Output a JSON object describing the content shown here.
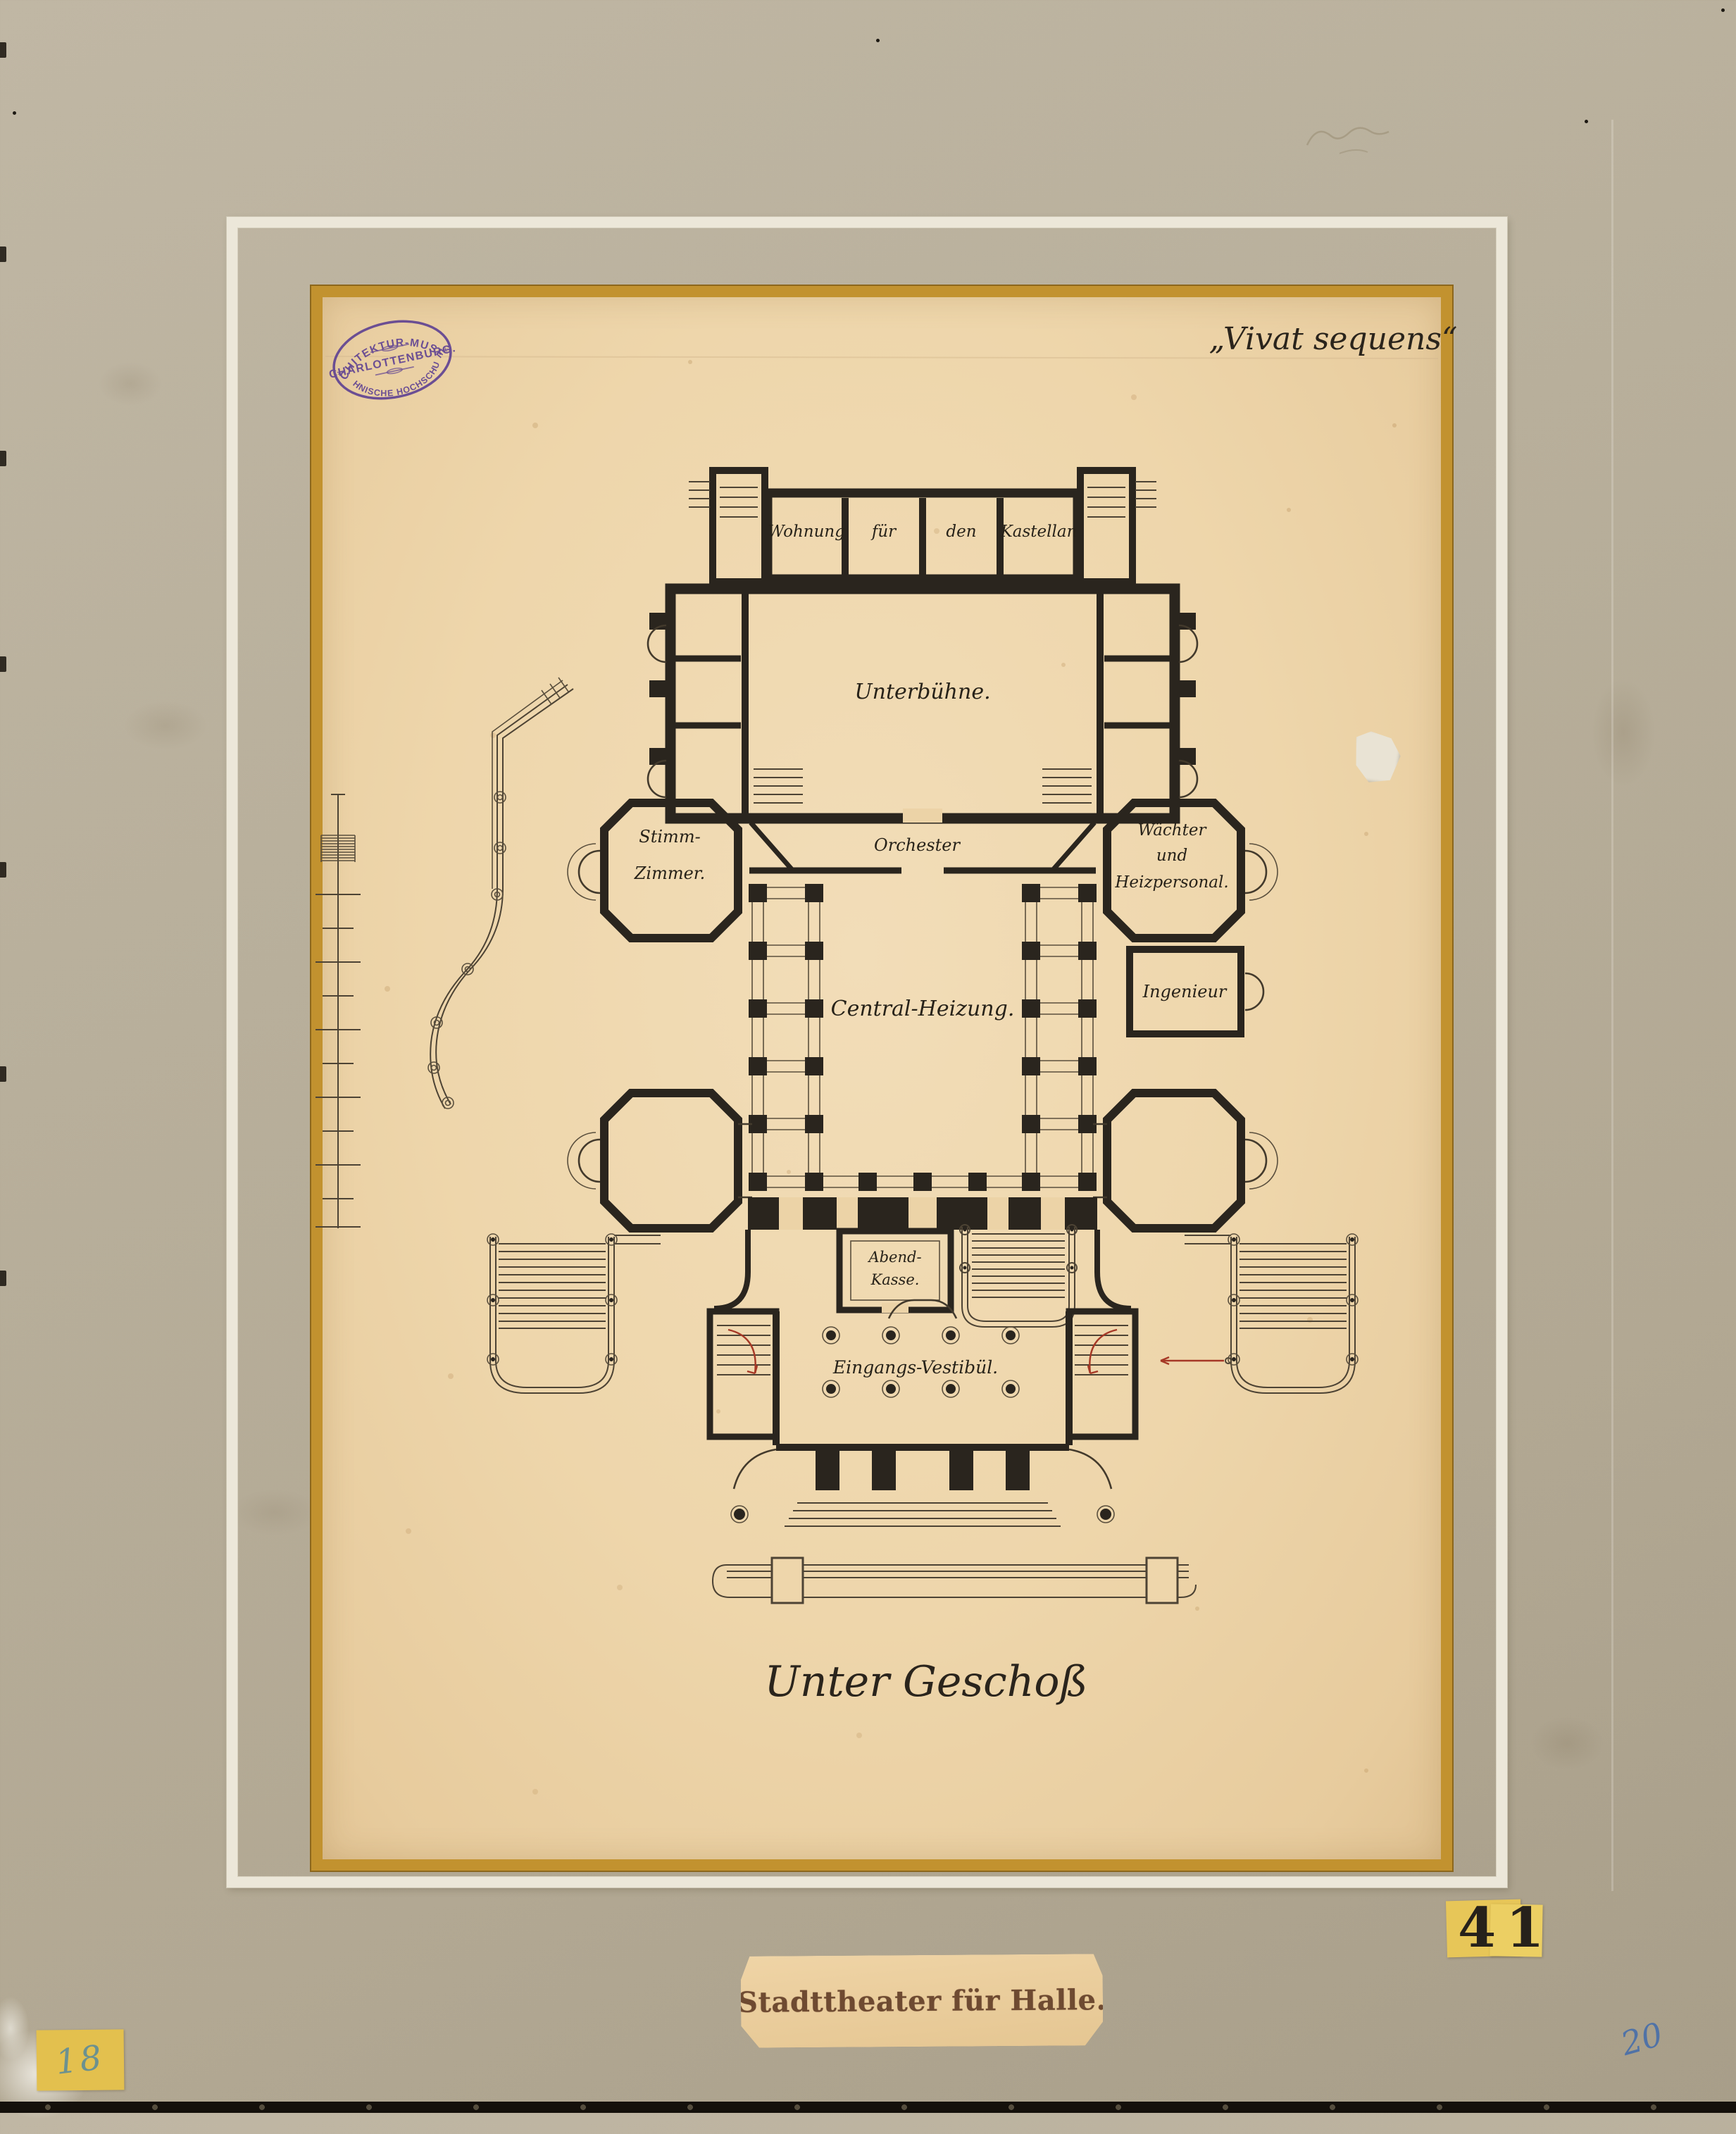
{
  "artwork": {
    "motto": "„Vivat sequens“",
    "caption": "Unter Geschoß",
    "title": "Stadttheater für Halle.",
    "inventory_number": "41",
    "corner_number": "18",
    "pencil_number": "20"
  },
  "stamp": {
    "line1": "ARCHITEKTUR-MUSEUM",
    "line2": "CHARLOTTENBURG.",
    "line3": "TECHNISCHE HOCHSCHULE."
  },
  "rooms": {
    "wohnung": "Wohnung",
    "fuer": "für",
    "den": "den",
    "kastellan": "Kastellan",
    "unterbuehne": "Unterbühne.",
    "stimm1": "Stimm-",
    "stimm2": "Zimmer.",
    "orchester": "Orchester",
    "waechter1": "Wächter",
    "waechter2": "und",
    "waechter3": "Heizpersonal.",
    "ingenieur": "Ingenieur",
    "central": "Central-Heizung.",
    "abend1": "Abend-",
    "abend2": "Kasse.",
    "vestibuel": "Eingangs-Vestibül."
  },
  "colors": {
    "mat": "#b8af9b",
    "paper": "#eed6ab",
    "gold_frame": "#c2922f",
    "white_frame": "#ece7d9",
    "ink": "#2a251e",
    "stamp_purple": "#5a3d92",
    "label_yellow": "#e7c658",
    "accent_red": "#a63826",
    "pencil_blue": "#3a68ae"
  }
}
